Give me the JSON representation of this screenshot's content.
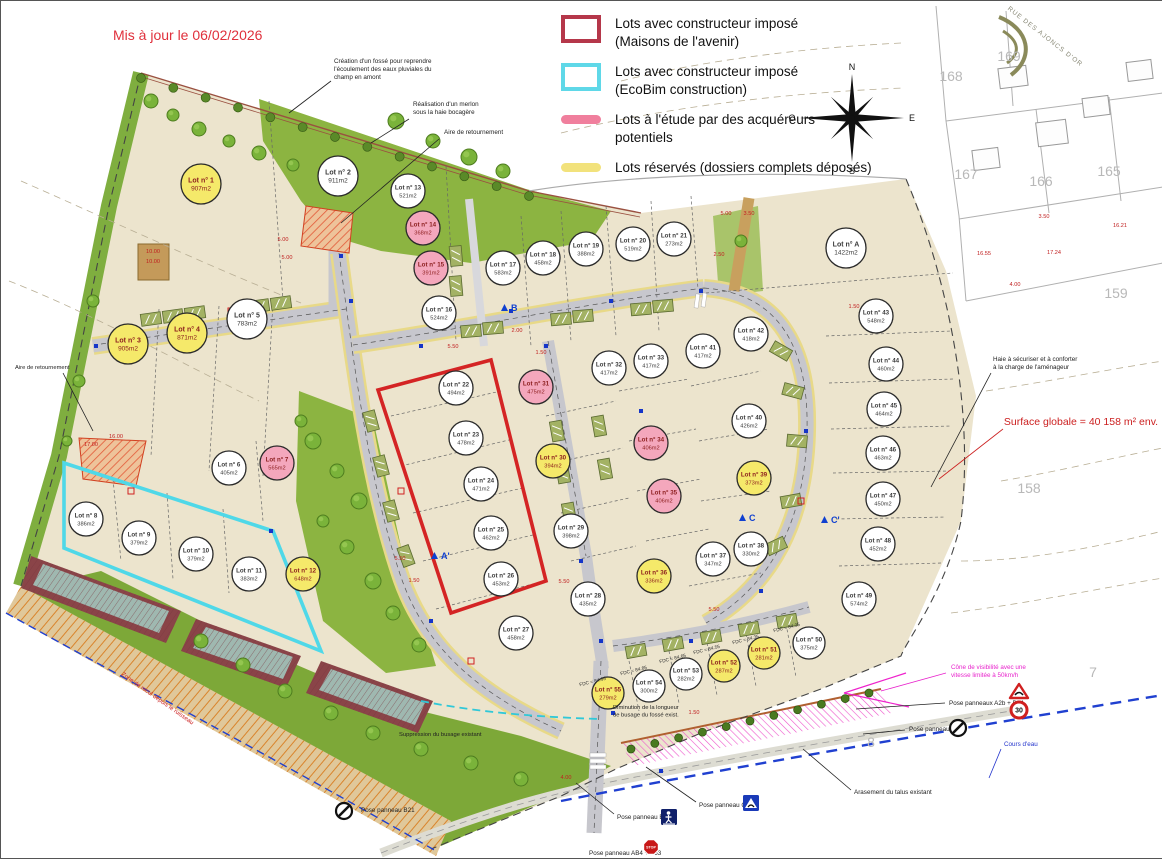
{
  "meta": {
    "updated_label": "Mis à jour le 06/02/2026",
    "surface_label": "Surface globale = 40 158 m² env."
  },
  "legend": [
    {
      "swatch": "outline",
      "color": "#b5374a",
      "lines": [
        "Lots avec constructeur imposé",
        "(Maisons de l'avenir)"
      ]
    },
    {
      "swatch": "outline",
      "color": "#5fd8e8",
      "lines": [
        "Lots avec constructeur imposé",
        "(EcoBim construction)"
      ]
    },
    {
      "swatch": "blob",
      "color": "#f07f9d",
      "lines": [
        "Lots à l'étude par des acquéreurs",
        "potentiels"
      ]
    },
    {
      "swatch": "blob",
      "color": "#f2e27c",
      "lines": [
        "Lots réservés (dossiers complets déposés)",
        ""
      ]
    }
  ],
  "compass": {
    "n": "N",
    "s": "S",
    "e": "E",
    "w": "O"
  },
  "status_colors": {
    "free": "#ffffff",
    "reserved": "#f5e96a",
    "study": "#f4a7bc"
  },
  "lots": [
    {
      "name": "Lot n° 1",
      "area": "907m2",
      "x": 200,
      "y": 183,
      "r": 20,
      "status": "reserved"
    },
    {
      "name": "Lot n° 2",
      "area": "911m2",
      "x": 337,
      "y": 175,
      "r": 20,
      "status": "free"
    },
    {
      "name": "Lot n° 3",
      "area": "905m2",
      "x": 127,
      "y": 343,
      "r": 20,
      "status": "reserved"
    },
    {
      "name": "Lot n° 4",
      "area": "871m2",
      "x": 186,
      "y": 332,
      "r": 20,
      "status": "reserved"
    },
    {
      "name": "Lot n° 5",
      "area": "783m2",
      "x": 246,
      "y": 318,
      "r": 20,
      "status": "free"
    },
    {
      "name": "Lot n° 6",
      "area": "405m2",
      "x": 228,
      "y": 467,
      "r": 17,
      "status": "free"
    },
    {
      "name": "Lot n° 7",
      "area": "565m2",
      "x": 276,
      "y": 462,
      "r": 17,
      "status": "study"
    },
    {
      "name": "Lot n° 8",
      "area": "386m2",
      "x": 85,
      "y": 518,
      "r": 17,
      "status": "free"
    },
    {
      "name": "Lot n° 9",
      "area": "379m2",
      "x": 138,
      "y": 537,
      "r": 17,
      "status": "free"
    },
    {
      "name": "Lot n° 10",
      "area": "379m2",
      "x": 195,
      "y": 553,
      "r": 17,
      "status": "free"
    },
    {
      "name": "Lot n° 11",
      "area": "383m2",
      "x": 248,
      "y": 573,
      "r": 17,
      "status": "free"
    },
    {
      "name": "Lot n° 12",
      "area": "648m2",
      "x": 302,
      "y": 573,
      "r": 17,
      "status": "reserved"
    },
    {
      "name": "Lot n° 13",
      "area": "521m2",
      "x": 407,
      "y": 190,
      "r": 17,
      "status": "free"
    },
    {
      "name": "Lot n° 14",
      "area": "368m2",
      "x": 422,
      "y": 227,
      "r": 17,
      "status": "study"
    },
    {
      "name": "Lot n° 15",
      "area": "391m2",
      "x": 430,
      "y": 267,
      "r": 17,
      "status": "study"
    },
    {
      "name": "Lot n° 16",
      "area": "524m2",
      "x": 438,
      "y": 312,
      "r": 17,
      "status": "free"
    },
    {
      "name": "Lot n° 17",
      "area": "583m2",
      "x": 502,
      "y": 267,
      "r": 17,
      "status": "free"
    },
    {
      "name": "Lot n° 18",
      "area": "458m2",
      "x": 542,
      "y": 257,
      "r": 17,
      "status": "free"
    },
    {
      "name": "Lot n° 19",
      "area": "388m2",
      "x": 585,
      "y": 248,
      "r": 17,
      "status": "free"
    },
    {
      "name": "Lot n° 20",
      "area": "519m2",
      "x": 632,
      "y": 243,
      "r": 17,
      "status": "free"
    },
    {
      "name": "Lot n° 21",
      "area": "273m2",
      "x": 673,
      "y": 238,
      "r": 17,
      "status": "free"
    },
    {
      "name": "Lot n° 22",
      "area": "494m2",
      "x": 455,
      "y": 387,
      "r": 17,
      "status": "free"
    },
    {
      "name": "Lot n° 23",
      "area": "478m2",
      "x": 465,
      "y": 437,
      "r": 17,
      "status": "free"
    },
    {
      "name": "Lot n° 24",
      "area": "471m2",
      "x": 480,
      "y": 483,
      "r": 17,
      "status": "free"
    },
    {
      "name": "Lot n° 25",
      "area": "462m2",
      "x": 490,
      "y": 532,
      "r": 17,
      "status": "free"
    },
    {
      "name": "Lot n° 26",
      "area": "453m2",
      "x": 500,
      "y": 578,
      "r": 17,
      "status": "free"
    },
    {
      "name": "Lot n° 27",
      "area": "458m2",
      "x": 515,
      "y": 632,
      "r": 17,
      "status": "free"
    },
    {
      "name": "Lot n° 28",
      "area": "435m2",
      "x": 587,
      "y": 598,
      "r": 17,
      "status": "free"
    },
    {
      "name": "Lot n° 29",
      "area": "398m2",
      "x": 570,
      "y": 530,
      "r": 17,
      "status": "free"
    },
    {
      "name": "Lot n° 30",
      "area": "394m2",
      "x": 552,
      "y": 460,
      "r": 17,
      "status": "reserved"
    },
    {
      "name": "Lot n° 31",
      "area": "475m2",
      "x": 535,
      "y": 386,
      "r": 17,
      "status": "study"
    },
    {
      "name": "Lot n° 32",
      "area": "417m2",
      "x": 608,
      "y": 367,
      "r": 17,
      "status": "free"
    },
    {
      "name": "Lot n° 33",
      "area": "417m2",
      "x": 650,
      "y": 360,
      "r": 17,
      "status": "free"
    },
    {
      "name": "Lot n° 34",
      "area": "406m2",
      "x": 650,
      "y": 442,
      "r": 17,
      "status": "study"
    },
    {
      "name": "Lot n° 35",
      "area": "406m2",
      "x": 663,
      "y": 495,
      "r": 17,
      "status": "study"
    },
    {
      "name": "Lot n° 36",
      "area": "336m2",
      "x": 653,
      "y": 575,
      "r": 17,
      "status": "reserved"
    },
    {
      "name": "Lot n° 37",
      "area": "347m2",
      "x": 712,
      "y": 558,
      "r": 17,
      "status": "free"
    },
    {
      "name": "Lot n° 38",
      "area": "330m2",
      "x": 750,
      "y": 548,
      "r": 17,
      "status": "free"
    },
    {
      "name": "Lot n° 39",
      "area": "373m2",
      "x": 753,
      "y": 477,
      "r": 17,
      "status": "reserved"
    },
    {
      "name": "Lot n° 40",
      "area": "426m2",
      "x": 748,
      "y": 420,
      "r": 17,
      "status": "free"
    },
    {
      "name": "Lot n° 41",
      "area": "417m2",
      "x": 702,
      "y": 350,
      "r": 17,
      "status": "free"
    },
    {
      "name": "Lot n° 42",
      "area": "418m2",
      "x": 750,
      "y": 333,
      "r": 17,
      "status": "free"
    },
    {
      "name": "Lot n° 43",
      "area": "548m2",
      "x": 875,
      "y": 315,
      "r": 17,
      "status": "free"
    },
    {
      "name": "Lot n° 44",
      "area": "460m2",
      "x": 885,
      "y": 363,
      "r": 17,
      "status": "free"
    },
    {
      "name": "Lot n° 45",
      "area": "464m2",
      "x": 883,
      "y": 408,
      "r": 17,
      "status": "free"
    },
    {
      "name": "Lot n° 46",
      "area": "463m2",
      "x": 882,
      "y": 452,
      "r": 17,
      "status": "free"
    },
    {
      "name": "Lot n° 47",
      "area": "450m2",
      "x": 882,
      "y": 498,
      "r": 17,
      "status": "free"
    },
    {
      "name": "Lot n° 48",
      "area": "452m2",
      "x": 877,
      "y": 543,
      "r": 17,
      "status": "free"
    },
    {
      "name": "Lot n° 49",
      "area": "574m2",
      "x": 858,
      "y": 598,
      "r": 17,
      "status": "free"
    },
    {
      "name": "Lot n° 50",
      "area": "375m2",
      "x": 808,
      "y": 642,
      "r": 16,
      "status": "free"
    },
    {
      "name": "Lot n° 51",
      "area": "281m2",
      "x": 763,
      "y": 652,
      "r": 16,
      "status": "reserved"
    },
    {
      "name": "Lot n° 52",
      "area": "287m2",
      "x": 723,
      "y": 665,
      "r": 16,
      "status": "reserved"
    },
    {
      "name": "Lot n° 53",
      "area": "282m2",
      "x": 685,
      "y": 673,
      "r": 16,
      "status": "free"
    },
    {
      "name": "Lot n° 54",
      "area": "300m2",
      "x": 648,
      "y": 685,
      "r": 16,
      "status": "free"
    },
    {
      "name": "Lot n° 55",
      "area": "279m2",
      "x": 607,
      "y": 692,
      "r": 16,
      "status": "reserved"
    },
    {
      "name": "Lot n° A",
      "area": "1422m2",
      "x": 845,
      "y": 247,
      "r": 20,
      "status": "free"
    }
  ],
  "annotations": [
    {
      "lines": [
        "Création d'un fossé pour reprendre",
        "l'écoulement des eaux pluviales du",
        "champ en amont"
      ],
      "x": 333,
      "y": 62,
      "lead": [
        330,
        80,
        288,
        112
      ]
    },
    {
      "lines": [
        "Réalisation d'un merlon",
        "sous la haie bocagère"
      ],
      "x": 412,
      "y": 105,
      "lead": [
        408,
        118,
        370,
        142
      ]
    },
    {
      "lines": [
        "Aire de retournement"
      ],
      "x": 443,
      "y": 133,
      "lead": [
        438,
        138,
        340,
        222
      ]
    },
    {
      "lines": [
        "Aire de retournement"
      ],
      "x": 14,
      "y": 368,
      "size": 5.8,
      "lead": [
        62,
        372,
        92,
        430
      ]
    },
    {
      "lines": [
        "Haie à sécuriser et à conforter",
        "à la charge de l'aménageur"
      ],
      "x": 992,
      "y": 360,
      "lead": [
        990,
        372,
        930,
        486
      ]
    },
    {
      "lines": [
        "Cône de visibilité avec une",
        "vitesse limitée à 50km/h"
      ],
      "x": 950,
      "y": 668,
      "color": "#e822cc",
      "lead": [
        945,
        672,
        880,
        690
      ]
    },
    {
      "lines": [
        "Pose panneaux A2b + B14"
      ],
      "x": 948,
      "y": 704,
      "lead": [
        944,
        702,
        855,
        708
      ]
    },
    {
      "lines": [
        "Pose panneau B21"
      ],
      "x": 908,
      "y": 730,
      "lead": [
        904,
        729,
        862,
        733
      ]
    },
    {
      "lines": [
        "Cours d'eau"
      ],
      "x": 1003,
      "y": 745,
      "color": "#2233cc",
      "lead": [
        1000,
        748,
        988,
        777
      ]
    },
    {
      "lines": [
        "Arasement du talus existant"
      ],
      "x": 853,
      "y": 793,
      "lead": [
        850,
        789,
        802,
        748
      ]
    },
    {
      "lines": [
        "Pose panneau C27"
      ],
      "x": 698,
      "y": 806,
      "lead": [
        695,
        801,
        645,
        766
      ]
    },
    {
      "lines": [
        "Pose panneau B52"
      ],
      "x": 616,
      "y": 818,
      "lead": [
        613,
        813,
        575,
        782
      ]
    },
    {
      "lines": [
        "Pose panneau B21"
      ],
      "x": 360,
      "y": 811
    },
    {
      "lines": [
        "Pose panneau AB4 + B53"
      ],
      "x": 588,
      "y": 854
    },
    {
      "lines": [
        "Suppression du busage existant"
      ],
      "x": 398,
      "y": 735,
      "size": 5.8
    },
    {
      "lines": [
        "Diminution de la longueur",
        "de busage du fossé exist."
      ],
      "x": 612,
      "y": 708,
      "size": 5.8
    },
    {
      "lines": [
        "Zone de recul depuis le ruisseau"
      ],
      "x": 120,
      "y": 674,
      "color": "#cc2020",
      "rot": 35,
      "size": 6
    }
  ],
  "surface_note": {
    "x": 1080,
    "y": 424,
    "size": 10.5,
    "color": "#cc2020",
    "lead": [
      1002,
      428,
      938,
      478
    ]
  },
  "dims": [
    {
      "t": "10.00",
      "x": 152,
      "y": 252
    },
    {
      "t": "10.00",
      "x": 152,
      "y": 262
    },
    {
      "t": "16.00",
      "x": 115,
      "y": 437
    },
    {
      "t": "17.00",
      "x": 90,
      "y": 445
    },
    {
      "t": "5.00",
      "x": 282,
      "y": 240
    },
    {
      "t": "5.00",
      "x": 286,
      "y": 258
    },
    {
      "t": "2.00",
      "x": 516,
      "y": 331
    },
    {
      "t": "1.50",
      "x": 540,
      "y": 353
    },
    {
      "t": "5.50",
      "x": 452,
      "y": 347
    },
    {
      "t": "5.00",
      "x": 725,
      "y": 214
    },
    {
      "t": "3.50",
      "x": 748,
      "y": 214
    },
    {
      "t": "2.50",
      "x": 718,
      "y": 255
    },
    {
      "t": "1.50",
      "x": 853,
      "y": 307
    },
    {
      "t": "5.50",
      "x": 399,
      "y": 559
    },
    {
      "t": "1.50",
      "x": 413,
      "y": 581
    },
    {
      "t": "5.50",
      "x": 563,
      "y": 582
    },
    {
      "t": "5.50",
      "x": 713,
      "y": 610
    },
    {
      "t": "4.00",
      "x": 565,
      "y": 778
    },
    {
      "t": "1.50",
      "x": 693,
      "y": 713
    },
    {
      "t": "3.50",
      "x": 1043,
      "y": 217
    },
    {
      "t": "16.21",
      "x": 1119,
      "y": 226
    },
    {
      "t": "16.55",
      "x": 983,
      "y": 254
    },
    {
      "t": "17.24",
      "x": 1053,
      "y": 253
    },
    {
      "t": "4.00",
      "x": 1014,
      "y": 285
    }
  ],
  "parcels": [
    {
      "n": "169",
      "x": 1008,
      "y": 60
    },
    {
      "n": "168",
      "x": 950,
      "y": 80
    },
    {
      "n": "167",
      "x": 965,
      "y": 178
    },
    {
      "n": "166",
      "x": 1040,
      "y": 185
    },
    {
      "n": "165",
      "x": 1108,
      "y": 175
    },
    {
      "n": "159",
      "x": 1115,
      "y": 297
    },
    {
      "n": "158",
      "x": 1028,
      "y": 492
    },
    {
      "n": "7",
      "x": 1092,
      "y": 676
    },
    {
      "n": "8",
      "x": 870,
      "y": 746
    }
  ],
  "street": {
    "label": "RUE DES AJONCS D'OR",
    "x": 1043,
    "y": 37,
    "rot": 38
  },
  "sections": [
    {
      "t": "A'",
      "x": 440,
      "y": 556
    },
    {
      "t": "B",
      "x": 510,
      "y": 308
    },
    {
      "t": "C",
      "x": 748,
      "y": 518
    },
    {
      "t": "C'",
      "x": 830,
      "y": 520
    }
  ],
  "fdc": [
    {
      "t": "FDC = 84.95",
      "x": 592,
      "y": 682
    },
    {
      "t": "FDC = 84.85",
      "x": 633,
      "y": 671
    },
    {
      "t": "FDC = 84.65",
      "x": 672,
      "y": 659
    },
    {
      "t": "FDC = 84.55",
      "x": 706,
      "y": 650
    },
    {
      "t": "FDC = 84.35",
      "x": 745,
      "y": 640
    },
    {
      "t": "FDC = 84.35",
      "x": 786,
      "y": 628
    }
  ],
  "signs": [
    {
      "type": "triangle-warning",
      "x": 1018,
      "y": 691
    },
    {
      "type": "speed-limit",
      "x": 1018,
      "y": 709,
      "label": "30"
    },
    {
      "type": "no-entry",
      "x": 957,
      "y": 727
    },
    {
      "type": "no-entry",
      "x": 343,
      "y": 810
    },
    {
      "type": "speed-hump",
      "x": 750,
      "y": 802
    },
    {
      "type": "pedestrian",
      "x": 668,
      "y": 816
    },
    {
      "type": "stop",
      "x": 650,
      "y": 846,
      "label": "STOP"
    }
  ]
}
